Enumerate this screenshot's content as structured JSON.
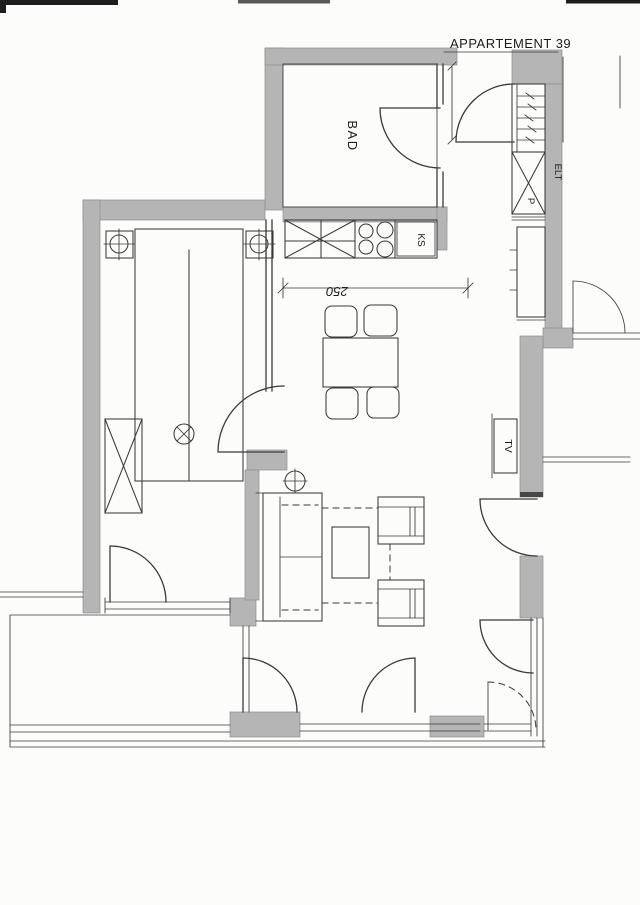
{
  "title": {
    "label": "APPARTEMENT 39"
  },
  "labels": {
    "bathroom": "BAD",
    "fridge": "KS",
    "electrical": "ELT",
    "pantry": "P",
    "tv": "TV"
  },
  "dimensions": {
    "kitchen_width": "250"
  },
  "colors": {
    "paper": "#fcfcfa",
    "wall_fill": "#b5b5b5",
    "wall_edge": "#8d8d8d",
    "line": "#3a3a3a",
    "ink": "#1c1c1c"
  }
}
